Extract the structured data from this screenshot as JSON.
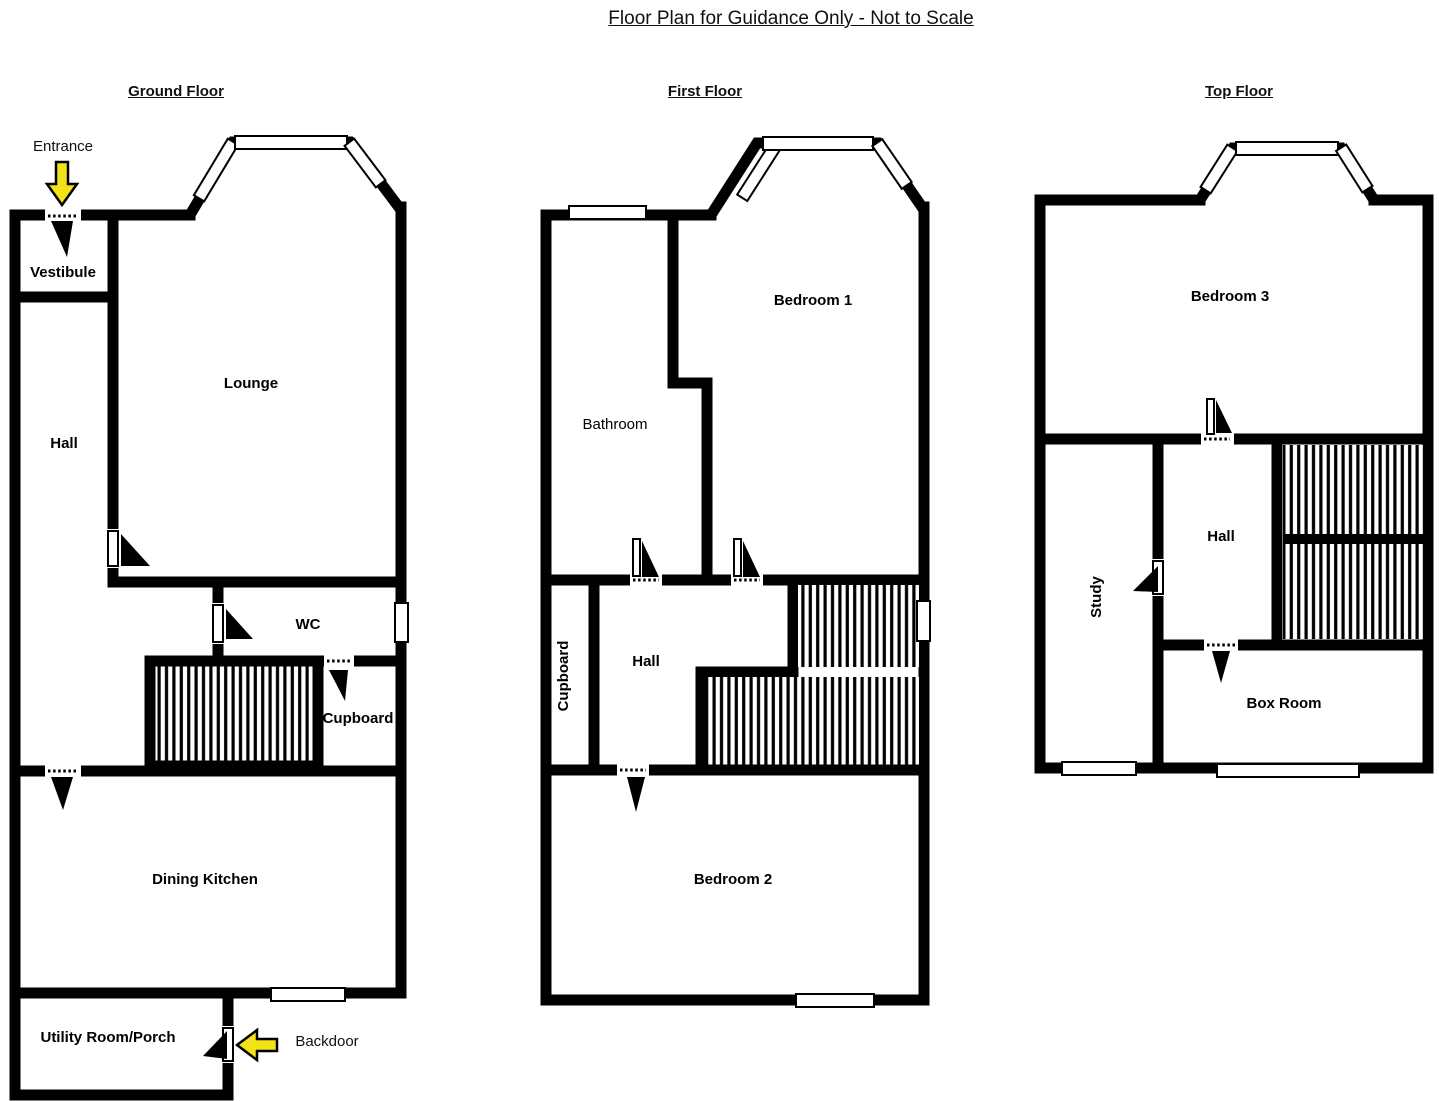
{
  "title": "Floor Plan for Guidance Only - Not to Scale",
  "colors": {
    "wall": "#000000",
    "background": "#FFFFFF",
    "arrow_fill": "#F2E318"
  },
  "floors": {
    "ground": {
      "title": "Ground Floor",
      "rooms": {
        "vestibule": "Vestibule",
        "hall": "Hall",
        "lounge": "Lounge",
        "wc": "WC",
        "cupboard": "Cupboard",
        "dining_kitchen": "Dining Kitchen",
        "utility": "Utility Room/Porch"
      },
      "annotations": {
        "entrance": "Entrance",
        "backdoor": "Backdoor"
      }
    },
    "first": {
      "title": "First Floor",
      "rooms": {
        "bedroom1": "Bedroom 1",
        "bathroom": "Bathroom",
        "cupboard": "Cupboard",
        "hall": "Hall",
        "bedroom2": "Bedroom 2"
      }
    },
    "top": {
      "title": "Top Floor",
      "rooms": {
        "bedroom3": "Bedroom 3",
        "study": "Study",
        "hall": "Hall",
        "box_room": "Box Room"
      }
    }
  },
  "icons": {
    "entrance_arrow": "arrow-down",
    "backdoor_arrow": "arrow-left",
    "stairs": "hatched-stairs",
    "door": "door-swing"
  }
}
